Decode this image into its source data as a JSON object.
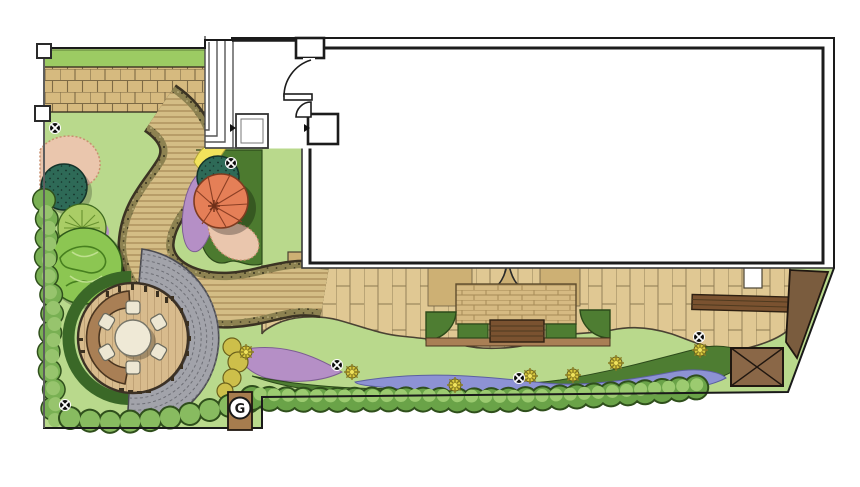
{
  "plan": {
    "type": "residential-garden-landscape-plan",
    "markers": {
      "utility_label": "G",
      "light_count": 6,
      "chair_count": 6,
      "table_count": 1
    }
  },
  "palette": {
    "lawn": "#b9d98c",
    "strip_green": "#9ccb63",
    "paver_band": "#d6ba7f",
    "paving": "#e0c893",
    "paving_dark": "#cdb074",
    "brick_panel": "#d6ba82",
    "path_tan": "#d4bd85",
    "gravel_edge": "#8d8251",
    "gray_setts": "#a2a3aa",
    "deck_wood": "#d8bb8d",
    "bench_brown": "#a97f55",
    "dark_bench": "#7a5230",
    "hedge_green": "#3a6827",
    "olive_bed": "#4c7a2f",
    "dark_band": "#4e7d32",
    "purple": "#b58fc6",
    "periwinkle": "#8d92d4",
    "pink": "#eac6ad",
    "orange_tree": "#e57f57",
    "teal_shrub": "#2e6a57",
    "tree_green": "#8cc652",
    "spiky_tree": "#aacd66",
    "yellow_patch": "#f2e35c",
    "golden_shrub": "#cdbf4a",
    "shed_brown": "#8a6747",
    "raised_bed_brown": "#7a5c3e",
    "post_brown": "#a67c4e"
  }
}
